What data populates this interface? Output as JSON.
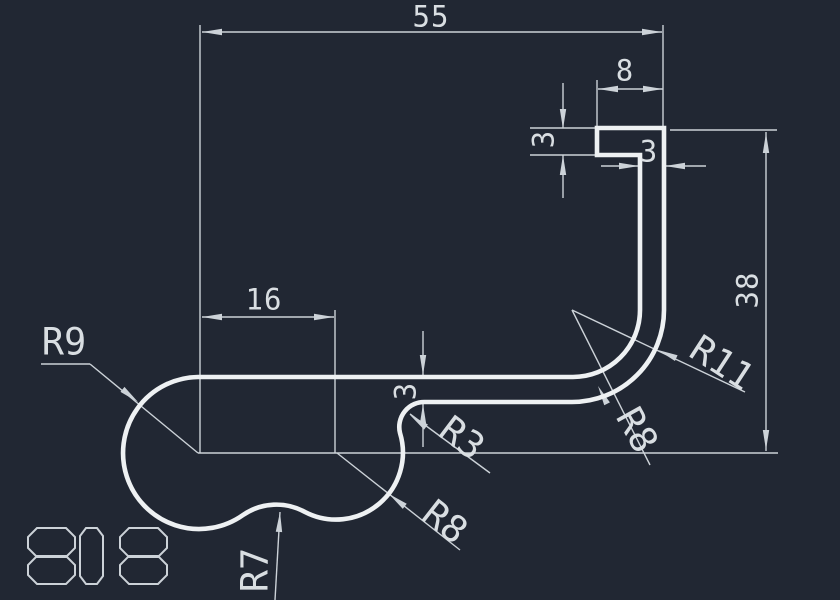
{
  "app": {
    "name": "cad-drawing-view"
  },
  "colors": {
    "background": "#212733",
    "profile_line": "#eef1f3",
    "dimension_line": "#ccd2d8",
    "text": "#d9dee2"
  },
  "stamp": {
    "drawing_number": "808"
  },
  "dimensions": {
    "overall_width": "55",
    "hook_flange_width": "8",
    "flange_thickness": "3",
    "stem_thickness": "3",
    "overall_height": "38",
    "bulb_center_offset": "16",
    "wall_thickness": "3"
  },
  "radius_labels": {
    "bulb": "R9",
    "step_fillet": "R3",
    "bottom_concave": "R8",
    "waist": "R7",
    "bend_inner": "R8",
    "bend_outer": "R11"
  }
}
